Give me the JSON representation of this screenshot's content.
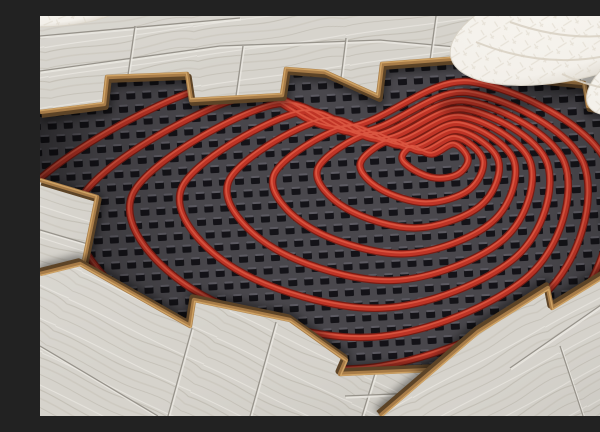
{
  "scene": {
    "alt": "Photograph of an underfloor heating installation: red heating pipe laid in a heart-shaped spiral on a black studded insulation mat, partially covered by light oak laminate planks cut in a staircase pattern, with a white quilted cushion in the top-right corner",
    "canvas": {
      "width": 600,
      "height": 400
    },
    "colors": {
      "mat_base": "#4a484d",
      "stud": "#141318",
      "stud_hi": "#77747d",
      "pipe_dark": "#7c1d14",
      "pipe_main": "#c23527",
      "pipe_hi": "#e8654c",
      "wood_base": "#d6d3cc",
      "wood_light": "#ebe8e2",
      "grain": "#c2beb4",
      "grain2": "#cdc9c0",
      "seam": "#97938b",
      "edge_tan": "#a87c48",
      "edge_dark": "#5d4427",
      "edge_hi": "#cfa365",
      "textile": "#f3f0ea",
      "textile_deep": "#d3ccc0",
      "stitch": "#d9d2c4"
    },
    "mat": {
      "rotate": -3,
      "stud": {
        "pw": 16,
        "ph": 26,
        "w": 9,
        "h": 8
      }
    },
    "pipes": {
      "rings": 9,
      "ease": 0.85,
      "w_dark": 7.6,
      "w_main": 5.2,
      "w_hi": 1.7,
      "outer": [
        [
          170,
          70
        ],
        [
          300,
          112
        ],
        [
          432,
          66
        ],
        [
          568,
          150
        ],
        [
          520,
          305
        ],
        [
          300,
          392
        ],
        [
          60,
          330
        ],
        [
          -28,
          196
        ]
      ],
      "inner": [
        [
          372,
          131
        ],
        [
          392,
          138
        ],
        [
          414,
          128
        ],
        [
          428,
          143
        ],
        [
          418,
          158
        ],
        [
          396,
          162
        ],
        [
          374,
          154
        ],
        [
          362,
          142
        ]
      ]
    },
    "planks": {
      "groups": [
        {
          "id": "planks-top",
          "grain_angle": -8,
          "poly": [
            [
              0,
              0
            ],
            [
              600,
              0
            ],
            [
              600,
              98
            ],
            [
              548,
              90
            ],
            [
              544,
              67
            ],
            [
              493,
              62
            ],
            [
              441,
              47
            ],
            [
              421,
              42
            ],
            [
              342,
              48
            ],
            [
              338,
              80
            ],
            [
              285,
              56
            ],
            [
              246,
              53
            ],
            [
              242,
              79
            ],
            [
              151,
              84
            ],
            [
              147,
              58
            ],
            [
              67,
              61
            ],
            [
              64,
              88
            ],
            [
              0,
              96
            ]
          ],
          "edge": [
            [
              0,
              96
            ],
            [
              64,
              88
            ],
            [
              67,
              61
            ],
            [
              147,
              58
            ],
            [
              151,
              84
            ],
            [
              242,
              79
            ],
            [
              246,
              53
            ],
            [
              285,
              56
            ],
            [
              338,
              80
            ],
            [
              342,
              48
            ],
            [
              421,
              42
            ],
            [
              441,
              47
            ],
            [
              493,
              62
            ],
            [
              544,
              67
            ],
            [
              548,
              90
            ],
            [
              600,
              98
            ]
          ],
          "edge_off": [
            1.6,
            2.8
          ],
          "hi_off": [
            -0.6,
            -1.2
          ],
          "shadow_off": [
            2,
            5
          ],
          "seams": [
            [
              [
                0,
                55
              ],
              [
                180,
                30
              ],
              [
                340,
                24
              ],
              [
                470,
                36
              ],
              [
                600,
                58
              ]
            ],
            [
              [
                0,
                20
              ],
              [
                200,
                2
              ]
            ],
            [
              [
                88,
                59
              ],
              [
                95,
                10
              ]
            ],
            [
              [
                196,
                80
              ],
              [
                203,
                30
              ]
            ],
            [
              [
                300,
                70
              ],
              [
                306,
                22
              ]
            ],
            [
              [
                390,
                44
              ],
              [
                396,
                0
              ]
            ],
            [
              [
                472,
                56
              ],
              [
                479,
                10
              ]
            ],
            [
              [
                540,
                66
              ],
              [
                547,
                18
              ]
            ]
          ]
        },
        {
          "id": "plank-left-tip",
          "grain_angle": 17,
          "poly": [
            [
              0,
              164
            ],
            [
              57,
              181
            ],
            [
              44,
              245
            ],
            [
              0,
              255
            ]
          ],
          "edge": [
            [
              0,
              164
            ],
            [
              57,
              181
            ],
            [
              44,
              245
            ],
            [
              0,
              255
            ]
          ],
          "edge_off": [
            1.5,
            2.4
          ],
          "hi_off": [
            -0.6,
            -1.0
          ],
          "shadow_off": [
            2,
            3
          ],
          "seams": [
            [
              [
                0,
                214
              ],
              [
                48,
                228
              ]
            ]
          ]
        },
        {
          "id": "planks-bottom-left",
          "grain_angle": 26,
          "poly": [
            [
              0,
              258
            ],
            [
              40,
              248
            ],
            [
              150,
              310
            ],
            [
              154,
              284
            ],
            [
              250,
              304
            ],
            [
              306,
              344
            ],
            [
              300,
              358
            ],
            [
              438,
              352
            ],
            [
              452,
              400
            ],
            [
              0,
              400
            ]
          ],
          "edge": [
            [
              0,
              258
            ],
            [
              40,
              248
            ],
            [
              150,
              310
            ],
            [
              154,
              284
            ],
            [
              250,
              304
            ],
            [
              306,
              344
            ],
            [
              300,
              358
            ],
            [
              438,
              352
            ]
          ],
          "edge_off": [
            -1.4,
            -2.6
          ],
          "hi_off": [
            0.7,
            1.3
          ],
          "shadow_off": [
            -1,
            -4
          ],
          "seams": [
            [
              [
                0,
                330
              ],
              [
                118,
                400
              ]
            ],
            [
              [
                152,
                312
              ],
              [
                128,
                400
              ]
            ],
            [
              [
                236,
                306
              ],
              [
                210,
                400
              ]
            ],
            [
              [
                336,
                354
              ],
              [
                322,
                400
              ]
            ],
            [
              [
                305,
                380
              ],
              [
                452,
                374
              ]
            ]
          ]
        },
        {
          "id": "planks-bottom-right",
          "grain_angle": -28,
          "poly": [
            [
              340,
              400
            ],
            [
              438,
              316
            ],
            [
              508,
              272
            ],
            [
              512,
              292
            ],
            [
              600,
              238
            ],
            [
              600,
              400
            ]
          ],
          "edge": [
            [
              340,
              400
            ],
            [
              438,
              316
            ],
            [
              508,
              272
            ],
            [
              512,
              292
            ],
            [
              600,
              238
            ]
          ],
          "edge_off": [
            -1.6,
            -2.6
          ],
          "hi_off": [
            0.7,
            1.3
          ],
          "shadow_off": [
            -2,
            -4
          ],
          "seams": [
            [
              [
                470,
                352
              ],
              [
                600,
                262
              ]
            ],
            [
              [
                520,
                330
              ],
              [
                543,
                400
              ]
            ]
          ]
        },
        {
          "id": "plank-right-tip",
          "grain_angle": -28,
          "poly": [
            [
              568,
              210
            ],
            [
              586,
              152
            ],
            [
              600,
              146
            ],
            [
              600,
              216
            ]
          ],
          "edge": [
            [
              568,
              210
            ],
            [
              586,
              152
            ],
            [
              600,
              146
            ]
          ],
          "edge_off": [
            -1.5,
            -2.4
          ],
          "hi_off": [
            0.7,
            1.2
          ],
          "shadow_off": [
            -2,
            -3
          ],
          "seams": []
        }
      ]
    },
    "pillow": {
      "shadow": {
        "cx": 535,
        "cy": 62,
        "rx": 140,
        "ry": 22,
        "rot": -12
      },
      "blobs": [
        {
          "cx": 537,
          "cy": 10,
          "rx": 130,
          "ry": 52,
          "rot": -14
        },
        {
          "cx": 604,
          "cy": 58,
          "rx": 64,
          "ry": 30,
          "rot": -30
        }
      ],
      "creases": [
        "M436,26 C500,52 560,50 628,20",
        "M522,58 C560,76 600,80 640,66",
        "M470,6 C520,24 570,26 620,8"
      ]
    },
    "top_left_textile": {
      "cx": 20,
      "cy": -4,
      "rx": 60,
      "ry": 14,
      "rot": -5
    }
  }
}
